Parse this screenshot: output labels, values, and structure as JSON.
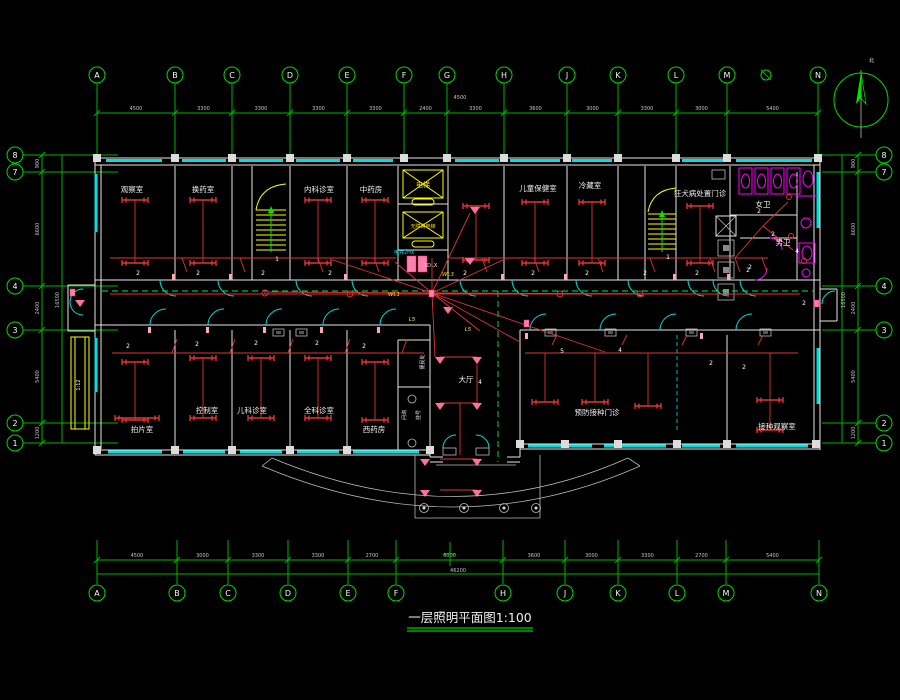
{
  "title": "一层照明平面图1:100",
  "north_label": "北",
  "axes": {
    "top": [
      "A",
      "B",
      "C",
      "D",
      "E",
      "F",
      "G",
      "H",
      "J",
      "K",
      "L",
      "M",
      "N"
    ],
    "bottom": [
      "A",
      "B",
      "C",
      "D",
      "E",
      "F",
      "H",
      "J",
      "K",
      "L",
      "M",
      "N"
    ],
    "left": [
      "8",
      "7",
      "4",
      "3",
      "2",
      "1"
    ],
    "right": [
      "8",
      "7",
      "4",
      "3",
      "2",
      "1"
    ]
  },
  "dimensions": {
    "top": [
      "4500",
      "3300",
      "3300",
      "3300",
      "3300",
      "2400",
      "3300",
      "3600",
      "3000",
      "3300",
      "3000",
      "5400"
    ],
    "top_note": "4500",
    "bottom": [
      "4500",
      "3000",
      "3300",
      "3300",
      "2700",
      "6000",
      "3600",
      "3000",
      "3300",
      "2700",
      "5400"
    ],
    "bottom_total": "46200",
    "left": [
      "900",
      "6600",
      "2400",
      "5400",
      "1200"
    ],
    "left_total": "16500",
    "right": [
      "900",
      "6600",
      "2400",
      "5400",
      "1200"
    ],
    "right_total": "16500"
  },
  "rooms": {
    "upper": [
      "观察室",
      "换药室",
      "内科诊室",
      "中药房",
      "儿童保健室",
      "冷藏室",
      "狂犬病处置门诊",
      "女卫",
      "男卫"
    ],
    "lower": [
      "拍片室",
      "控制室",
      "儿科诊室",
      "全科诊室",
      "西药房",
      "大厅",
      "预防接种门诊",
      "接种观察室"
    ]
  },
  "annotations": {
    "elevator": "电梯",
    "elevator2": "无障碍电梯",
    "shaft_label": "电井2HX",
    "panel_label": "1DLX",
    "inquiry": "问询",
    "registration": "挂号",
    "convenience": "便民处",
    "ramp": "1:12",
    "stair_number": "1",
    "switch_label": "2",
    "circuit_4": "4",
    "circuit_5": "5"
  },
  "wire_tags": [
    "WL1",
    "L5",
    "L5",
    "WL3"
  ]
}
